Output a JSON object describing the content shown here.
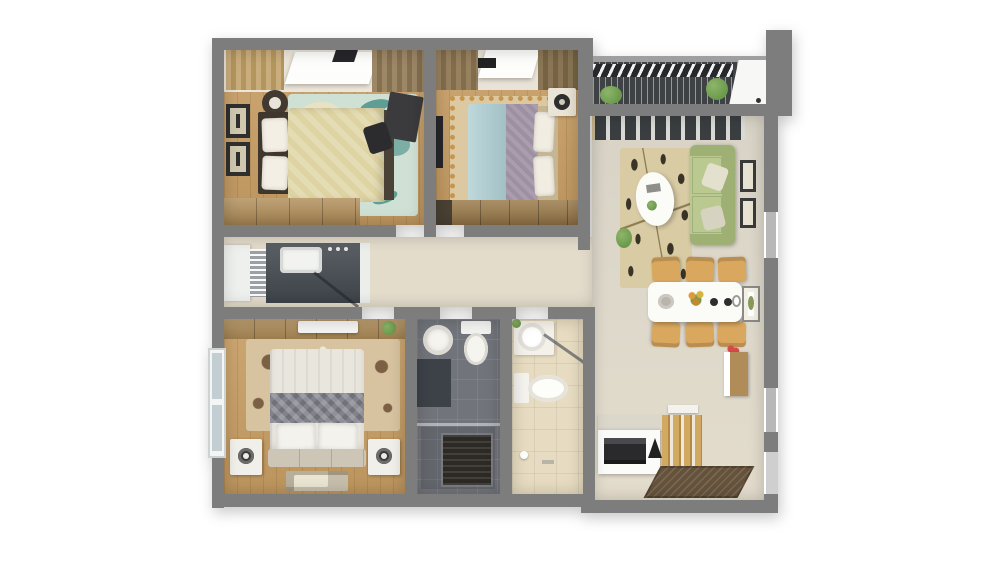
{
  "scene": {
    "kind": "apartment-floor-plan-3d-top-view",
    "background": "#ffffff",
    "visible_text": [],
    "rooms": [
      {
        "name": "bedroom-top-left",
        "furniture": [
          "double-bed-yellow-duvet",
          "dark-headboard",
          "two-pillows",
          "teal-fish-rug",
          "wall-frames",
          "round-basket",
          "desk",
          "chair",
          "wood-dresser",
          "window-with-curtains"
        ]
      },
      {
        "name": "bedroom-top-middle",
        "furniture": [
          "double-bed-blue-purple",
          "headboard",
          "two-pillows",
          "patterned-rug",
          "nightstand-with-lamp",
          "wall-tv",
          "wardrobe",
          "window-with-curtains"
        ]
      },
      {
        "name": "living-room",
        "furniture": [
          "green-sofa",
          "floral-leaf-rug",
          "white-oval-coffee-table",
          "sliding-door-curtain",
          "wall-frames",
          "floor-plant"
        ]
      },
      {
        "name": "dining-area",
        "furniture": [
          "white-dining-table",
          "six-tan-chairs",
          "flower-centerpiece",
          "plates",
          "wall-picture",
          "console-with-red-flowers"
        ]
      },
      {
        "name": "entry",
        "furniture": [
          "shoe-cabinet",
          "dark-appliance-front",
          "wood-slat-screen",
          "wall-shelf",
          "brown-doormat"
        ]
      },
      {
        "name": "kitchen-corridor",
        "furniture": [
          "dark-countertop",
          "white-sink",
          "dish-rack",
          "stove-knobs",
          "glass-panel"
        ]
      },
      {
        "name": "bedroom-bottom-left",
        "furniture": [
          "double-bed-white-duvet",
          "gray-chevron-runner",
          "two-pillows",
          "two-white-nightstands-with-lamps",
          "floral-brown-rug",
          "wardrobe-with-ac-unit",
          "left-wall-window",
          "floor-mat"
        ]
      },
      {
        "name": "bathroom-dark",
        "fixtures": [
          "round-sink",
          "toilet",
          "dark-vanity",
          "shower-mat",
          "glass-partition"
        ]
      },
      {
        "name": "bathroom-light",
        "fixtures": [
          "round-sink-on-counter",
          "toilet",
          "diagonal-glass-shower",
          "accessories"
        ]
      },
      {
        "name": "balcony",
        "furniture": [
          "slatted-deck",
          "two-plants",
          "white-ac-ledge",
          "railing"
        ]
      }
    ]
  },
  "palette": {
    "wall": "#7d7d7d",
    "wallLight": "#b7b7b7",
    "woodFloor": "#c79d63",
    "woodFurniture": "#b08d58",
    "woodFurnitureDark": "#9c7c4c",
    "corridorFloor": "#e4dccb",
    "rug1": "#cfe0d4",
    "rug1Accent": "#5f9e95",
    "rug2": "#dcc9a2",
    "rug2Accent": "#c7954e",
    "rug3": "#d7c3a0",
    "rug3Accent": "#7c6044",
    "rugLiving": "#d9cca5",
    "rugLivingLeaf": "#3a3426",
    "bed1Duvet": "#ded3a2",
    "bed1Head": "#3f372e",
    "bed2Sheet": "#aacbd0",
    "bed2Blanket": "#9e90a3",
    "bed2Head": "#c6b592",
    "bed3Duvet": "#e9e6de",
    "bed3Band": "#71717b",
    "bed3Head": "#cdc5b6",
    "sofa": "#b9c98f",
    "sofaDark": "#9fb074",
    "chair": "#daa75e",
    "counter": "#474e54",
    "bathDark": "#71757b",
    "bathLight": "#e7dcc1",
    "fixture": "#f6f4ef",
    "balconySlat": "#3f4245",
    "plant": "#6b9a4c",
    "doormat": "#64523b",
    "matDark": "#2d2a25",
    "flower": "#d84a4a"
  }
}
